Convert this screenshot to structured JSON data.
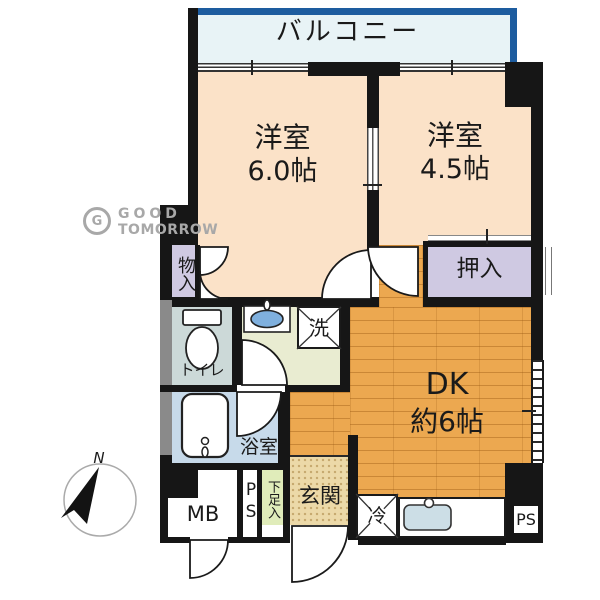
{
  "floorplan": {
    "balcony": {
      "label": "バルコニー"
    },
    "room_a": {
      "label": "洋室",
      "size": "6.0帖"
    },
    "room_b": {
      "label": "洋室",
      "size": "4.5帖"
    },
    "dk": {
      "label": "DK",
      "size": "約6帖"
    },
    "oshiire": {
      "label": "押入"
    },
    "monoire": {
      "label": "物入"
    },
    "toilet": {
      "label": "トイレ"
    },
    "washing_machine": {
      "label": "洗"
    },
    "bathroom": {
      "label": "浴室"
    },
    "entrance": {
      "label": "玄関"
    },
    "shoe_cabinet": {
      "label": "下足入"
    },
    "meter_box": {
      "label": "MB"
    },
    "pipe_space_left": {
      "label": "PS"
    },
    "pipe_space_right": {
      "label": "PS"
    },
    "refrigerator": {
      "label": "冷"
    }
  },
  "compass": {
    "north": "N"
  },
  "logo": {
    "monogram": "G",
    "line1": "GOOD",
    "line2": "TOMORROW"
  },
  "colors": {
    "wall": "#161616",
    "balcony_border": "#1d5c9f",
    "balcony_fill": "#e8f3f6",
    "room_fill": "#fbe2c8",
    "closet_fill": "#cfc9e2",
    "wood_floor": "#eca850",
    "entrance_tile": "#ecd9a8",
    "bathroom_fill": "#c7daea",
    "toilet_fill": "#ccd9d8",
    "washroom_fill": "#e9ecd1",
    "shoe_cabinet_fill": "#e0ecba",
    "sink_blue": "#7fb0de",
    "logo_gray": "#a8a8a8"
  }
}
